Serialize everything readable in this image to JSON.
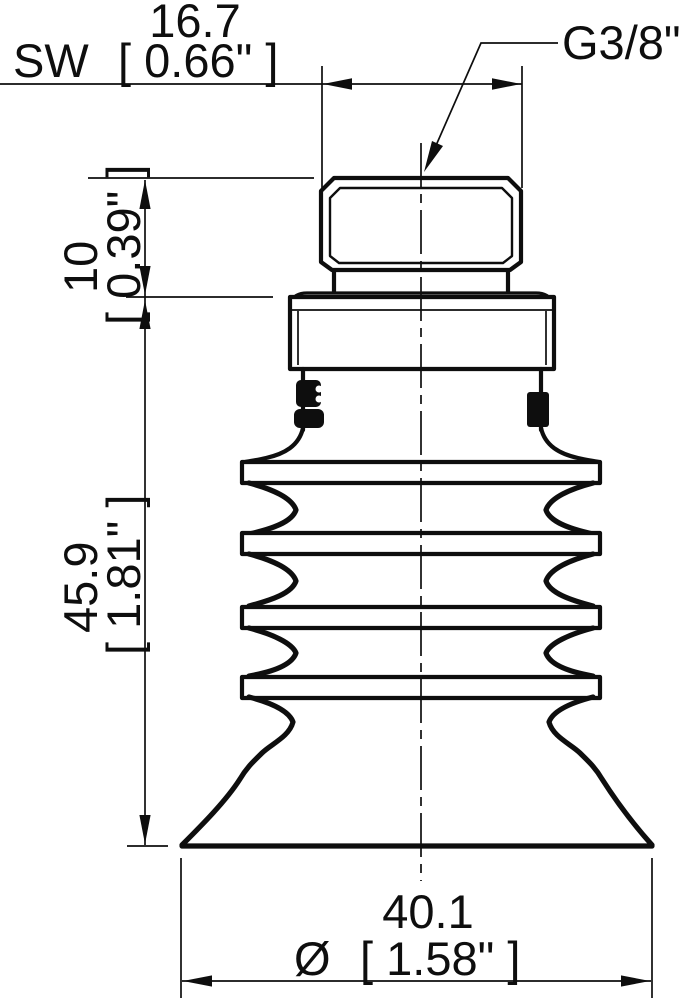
{
  "drawing": {
    "background": "#ffffff",
    "ink": "#0e0e0e",
    "part_name": "bellows suction cup side profile",
    "dimensions": {
      "wrench": {
        "prefix": "SW",
        "mm": "16.7",
        "inch": "[ 0.66\" ]"
      },
      "thread": {
        "label": "G3/8\""
      },
      "fitting_height": {
        "mm": "10",
        "inch": "[ 0.39\" ]"
      },
      "cup_height": {
        "mm": "45.9",
        "inch": "[ 1.81\" ]"
      },
      "lip_diameter": {
        "symbol": "Ø",
        "mm": "40.1",
        "inch": "[ 1.58\" ]"
      }
    }
  }
}
